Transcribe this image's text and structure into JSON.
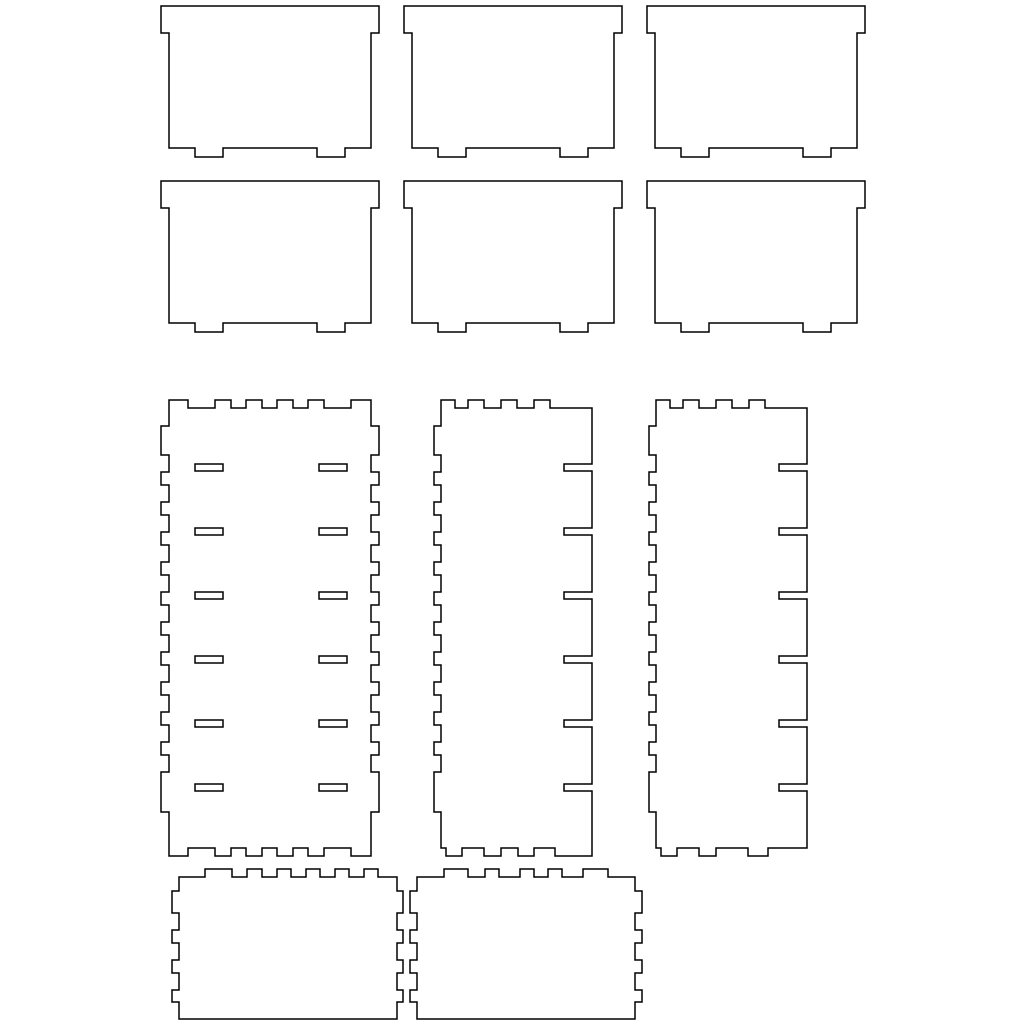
{
  "canvas": {
    "width": 1024,
    "height": 1024,
    "background": "#ffffff",
    "stroke_color": "#000000",
    "stroke_width": 1.5
  },
  "pieces": [
    {
      "name": "tray-panel-1",
      "x": 161,
      "y": 6,
      "path": "M0 0 H218 V27 H210 V142 H184 V151 H156 V142 H62 V151 H34 V142 H8 V27 H0 Z"
    },
    {
      "name": "tray-panel-2",
      "x": 404,
      "y": 6,
      "path": "M0 0 H218 V27 H210 V142 H184 V151 H156 V142 H62 V151 H34 V142 H8 V27 H0 Z"
    },
    {
      "name": "tray-panel-3",
      "x": 647,
      "y": 6,
      "path": "M0 0 H218 V27 H210 V142 H184 V151 H156 V142 H62 V151 H34 V142 H8 V27 H0 Z"
    },
    {
      "name": "tray-panel-4",
      "x": 161,
      "y": 181,
      "path": "M0 0 H218 V27 H210 V142 H184 V151 H156 V142 H62 V151 H34 V142 H8 V27 H0 Z"
    },
    {
      "name": "tray-panel-5",
      "x": 404,
      "y": 181,
      "path": "M0 0 H218 V27 H210 V142 H184 V151 H156 V142 H62 V151 H34 V142 H8 V27 H0 Z"
    },
    {
      "name": "tray-panel-6",
      "x": 647,
      "y": 181,
      "path": "M0 0 H218 V27 H210 V142 H184 V151 H156 V142 H62 V151 H34 V142 H8 V27 H0 Z"
    },
    {
      "name": "back-panel-slotted",
      "x": 161,
      "y": 400,
      "path": "M8 0 H27 V8 H54 V0 H70 V8 H85 V0 H101 V8 H116 V0 H132 V8 H147 V0 H163 V8 H190 V0 H210 V26 H218 V55 H210 V72 H218 V85 H210 V102 H218 V115 H210 V132 H218 V145 H210 V162 H218 V175 H210 V192 H218 V205 H210 V222 H218 V235 H210 V252 H218 V265 H210 V282 H218 V295 H210 V312 H218 V325 H210 V342 H218 V355 H210 V372 H218 V412 H210 V456 H190 V448 H163 V456 H147 V448 H132 V456 H116 V448 H101 V456 H85 V448 H70 V456 H54 V448 H27 V456 H8 V412 H0 V372 H8 V355 H0 V342 H8 V325 H0 V312 H8 V295 H0 V282 H8 V265 H0 V252 H8 V235 H0 V222 H8 V205 H0 V192 H8 V175 H0 V162 H8 V145 H0 V132 H8 V115 H0 V102 H8 V85 H0 V72 H8 V55 H0 V26 H8 Z M34 64 h28 v7 h-28 Z M158 64 h28 v7 h-28 Z M34 128 h28 v7 h-28 Z M158 128 h28 v7 h-28 Z M34 192 h28 v7 h-28 Z M158 192 h28 v7 h-28 Z M34 256 h28 v7 h-28 Z M158 256 h28 v7 h-28 Z M34 320 h28 v7 h-28 Z M158 320 h28 v7 h-28 Z M34 384 h28 v7 h-28 Z M158 384 h28 v7 h-28 Z"
    },
    {
      "name": "side-panel-notched-1",
      "x": 434,
      "y": 400,
      "path": "M7 0 H21 V8 H34 V0 H50 V8 H67 V0 H83 V8 H100 V0 H116 V8 H158 V64 H130 V71 H158 V128 H130 V135 H158 V192 H130 V199 H158 V256 H130 V263 H158 V320 H130 V327 H158 V384 H130 V391 H158 V456 H121 V448 H100 V456 H84 V448 H67 V456 H50 V448 H28 V456 H12 V448 H7 V412 H0 V372 H7 V355 H0 V342 H7 V325 H0 V312 H7 V295 H0 V282 H7 V265 H0 V252 H7 V235 H0 V222 H7 V205 H0 V192 H7 V175 H0 V162 H7 V145 H0 V132 H7 V115 H0 V102 H7 V85 H0 V72 H7 V55 H0 V26 H7 Z"
    },
    {
      "name": "side-panel-notched-2",
      "x": 649,
      "y": 400,
      "path": "M7 0 H21 V8 H34 V0 H50 V8 H67 V0 H83 V8 H100 V0 H116 V8 H158 V64 H130 V71 H158 V128 H130 V135 H158 V192 H130 V199 H158 V256 H130 V263 H158 V320 H130 V327 H158 V384 H130 V391 H158 V448 H119 V456 H99 V448 H67 V456 H50 V448 H28 V456 H12 V448 H7 V412 H0 V372 H7 V355 H0 V342 H7 V325 H0 V312 H7 V295 H0 V282 H7 V265 H0 V252 H7 V235 H0 V222 H7 V205 H0 V192 H7 V175 H0 V162 H7 V145 H0 V132 H7 V115 H0 V102 H7 V85 H0 V72 H7 V55 H0 V26 H7 Z"
    },
    {
      "name": "end-panel-1",
      "x": 172,
      "y": 869,
      "path": "M7 8 H33 V0 H60 V8 H75 V0 H90 V8 H105 V0 H119 V8 H134 V0 H148 V8 H163 V0 H177 V8 H192 V0 H206 V8 H225 V22 H231 V44 H225 V61 H231 V74 H225 V91 H231 V104 H225 V121 H231 V133 H225 V150 H7 V133 H0 V121 H7 V104 H0 V91 H7 V74 H0 V61 H7 V44 H0 V22 H7 Z"
    },
    {
      "name": "end-panel-2",
      "x": 410,
      "y": 869,
      "path": "M7 8 H34 V0 H58 V8 H75 V0 H89 V8 H110 V0 H124 V8 H138 V0 H152 V8 H173 V0 H198 V8 H225 V22 H232 V44 H225 V61 H232 V74 H225 V91 H232 V104 H225 V121 H232 V133 H225 V150 H7 V133 H0 V121 H7 V104 H0 V91 H7 V74 H0 V61 H7 V44 H0 V22 H7 Z"
    }
  ]
}
